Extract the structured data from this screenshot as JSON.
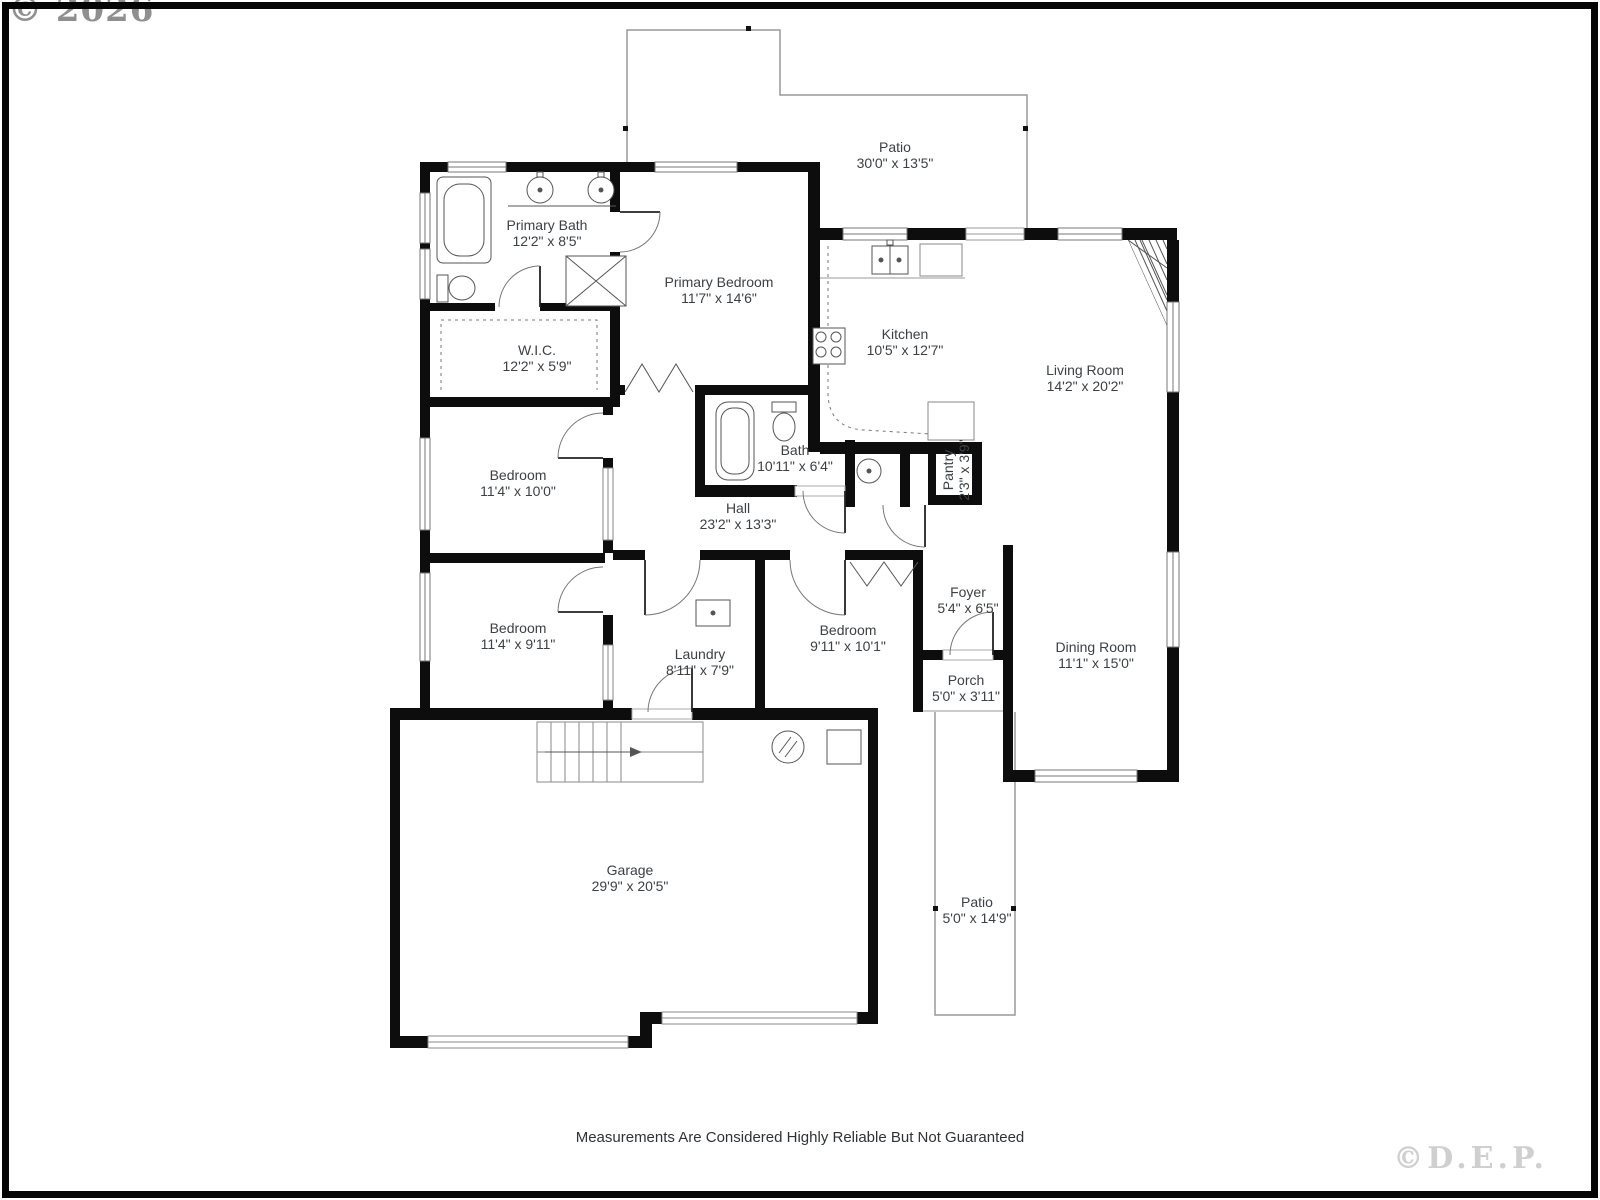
{
  "watermarks": {
    "top_left": "© 2026",
    "bottom_right": "©D.E.P."
  },
  "footer": {
    "disclaimer": "Measurements Are Considered Highly Reliable But Not Guaranteed"
  },
  "rooms": [
    {
      "id": "patio-top",
      "name": "Patio",
      "dims": "30'0\" x 13'5\""
    },
    {
      "id": "primary-bath",
      "name": "Primary Bath",
      "dims": "12'2\" x 8'5\""
    },
    {
      "id": "primary-bedroom",
      "name": "Primary Bedroom",
      "dims": "11'7\" x 14'6\""
    },
    {
      "id": "kitchen",
      "name": "Kitchen",
      "dims": "10'5\" x 12'7\""
    },
    {
      "id": "living-room",
      "name": "Living Room",
      "dims": "14'2\" x 20'2\""
    },
    {
      "id": "wic",
      "name": "W.I.C.",
      "dims": "12'2\" x 5'9\""
    },
    {
      "id": "bedroom-1",
      "name": "Bedroom",
      "dims": "11'4\" x 10'0\""
    },
    {
      "id": "bath",
      "name": "Bath",
      "dims": "10'11\" x 6'4\""
    },
    {
      "id": "hall",
      "name": "Hall",
      "dims": "23'2\" x 13'3\""
    },
    {
      "id": "pantry",
      "name": "Pantry",
      "dims": "2'3\" x 3'9\""
    },
    {
      "id": "bedroom-2",
      "name": "Bedroom",
      "dims": "11'4\" x 9'11\""
    },
    {
      "id": "laundry",
      "name": "Laundry",
      "dims": "8'11\" x 7'9\""
    },
    {
      "id": "bedroom-3",
      "name": "Bedroom",
      "dims": "9'11\" x 10'1\""
    },
    {
      "id": "foyer",
      "name": "Foyer",
      "dims": "5'4\" x 6'5\""
    },
    {
      "id": "porch",
      "name": "Porch",
      "dims": "5'0\" x 3'11\""
    },
    {
      "id": "dining-room",
      "name": "Dining Room",
      "dims": "11'1\" x 15'0\""
    },
    {
      "id": "garage",
      "name": "Garage",
      "dims": "29'9\" x 20'5\""
    },
    {
      "id": "patio-bottom",
      "name": "Patio",
      "dims": "5'0\" x 14'9\""
    }
  ],
  "colors": {
    "wall": "#0d0d0d",
    "label_text": "#3c4146",
    "outline_gray": "#999999",
    "watermark_top_left": "#8f8f8f",
    "watermark_bottom_right": "#cfcfcf"
  }
}
